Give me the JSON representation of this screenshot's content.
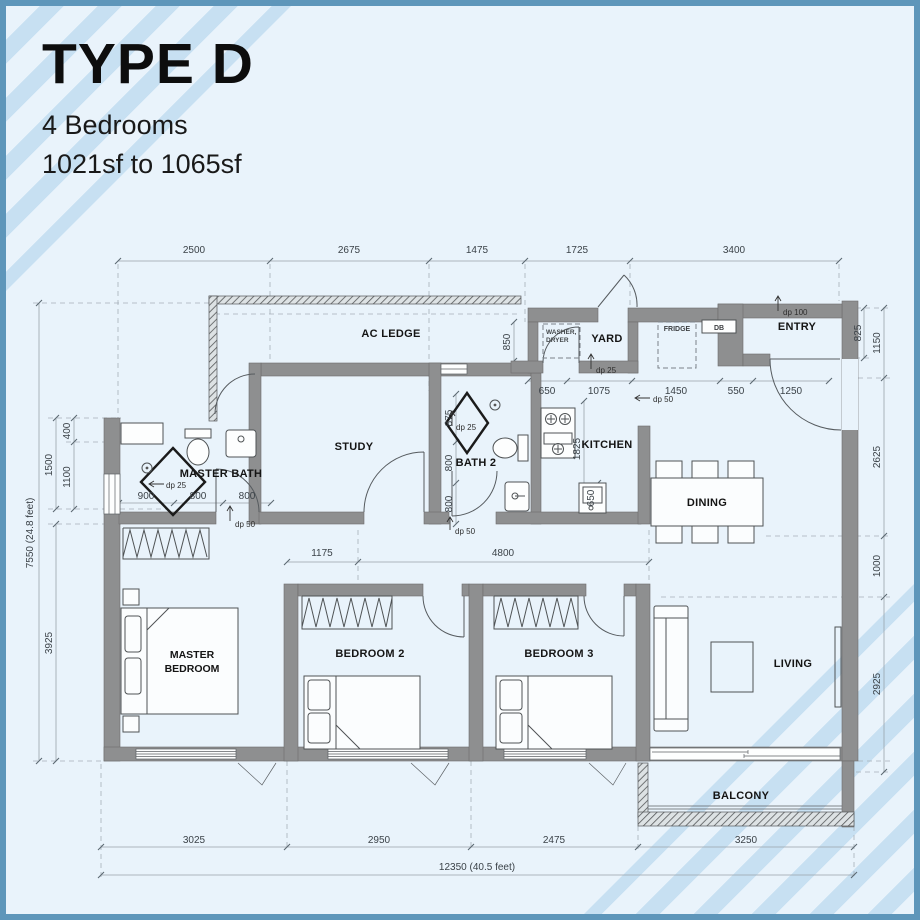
{
  "header": {
    "title": "TYPE D",
    "bedrooms": "4 Bedrooms",
    "area": "1021sf to 1065sf"
  },
  "rooms": {
    "ac_ledge": "AC LEDGE",
    "study": "STUDY",
    "master_bath": "MASTER BATH",
    "bath2": "BATH 2",
    "yard": "YARD",
    "kitchen": "KITCHEN",
    "entry": "ENTRY",
    "dining": "DINING",
    "master1": "MASTER",
    "master2": "BEDROOM",
    "bedroom2": "BEDROOM 2",
    "bedroom3": "BEDROOM 3",
    "living": "LIVING",
    "balcony": "BALCONY"
  },
  "appliances": {
    "washer1": "WASHER,",
    "washer2": "DRYER",
    "fridge": "FRIDGE",
    "db": "DB"
  },
  "dims": {
    "top": [
      "2500",
      "2675",
      "1475",
      "1725",
      "3400"
    ],
    "kitchen_row": [
      "650",
      "1075",
      "1450",
      "550",
      "1250"
    ],
    "right": [
      "825",
      "1150",
      "2625",
      "1000",
      "2925"
    ],
    "left_outer": "7550 (24.8 feet)",
    "left_inner": [
      "1500",
      "3925"
    ],
    "left_nested": [
      "400",
      "1100"
    ],
    "bath_row": [
      "900",
      "800",
      "800"
    ],
    "bath2_col": [
      "875",
      "800",
      "800"
    ],
    "hall_row": [
      "1175",
      "4800"
    ],
    "kitchen_col": [
      "1825",
      "650"
    ],
    "yard_col": "850",
    "bottom": [
      "3025",
      "2950",
      "2475",
      "3250"
    ],
    "bottom_total": "12350 (40.5 feet)"
  },
  "drops": {
    "dp25": "dp 25",
    "dp50": "dp 50",
    "dp100": "dp 100"
  }
}
